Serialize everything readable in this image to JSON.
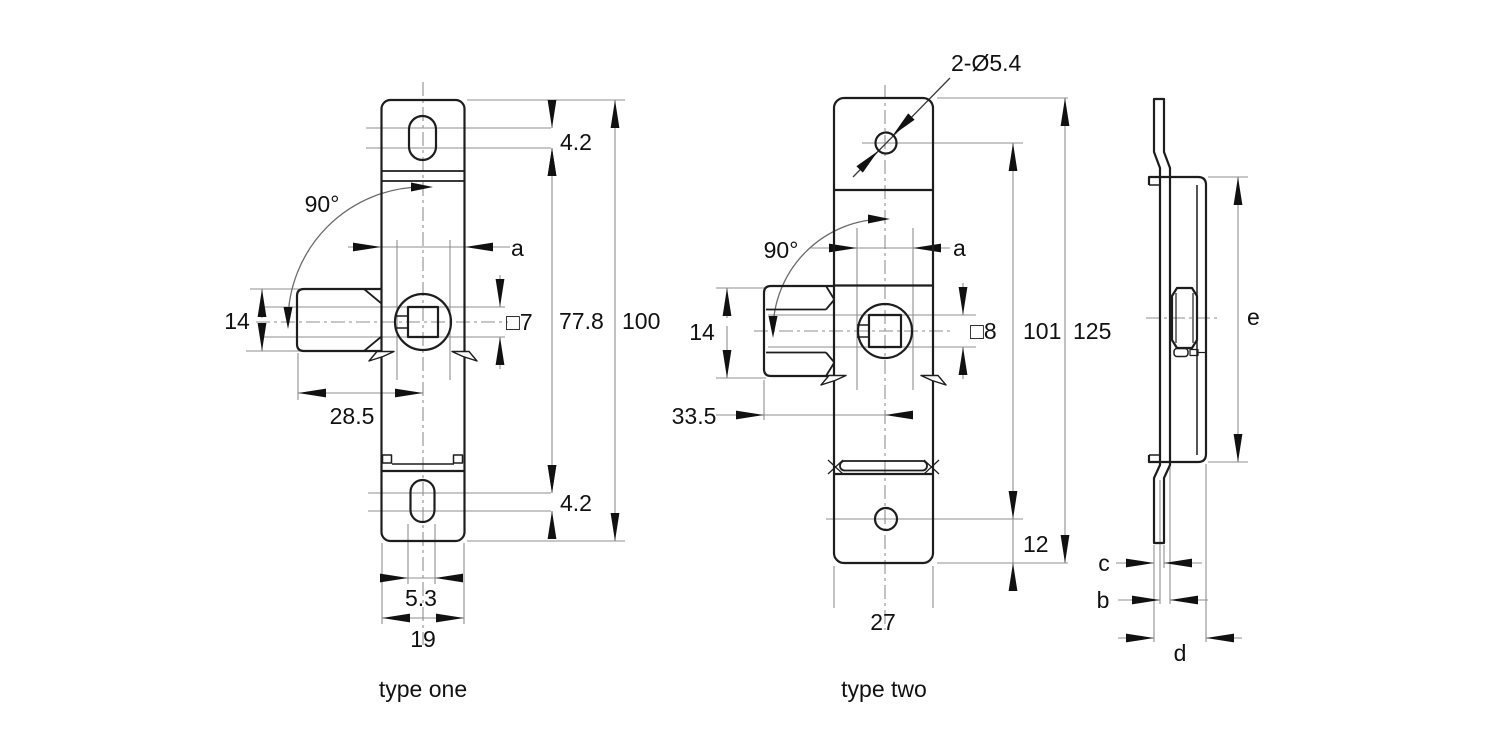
{
  "drawing": {
    "background_color": "#ffffff",
    "outline_color": "#1d1d1d",
    "thin_line_color": "#8f8f8f",
    "views": {
      "type_one": {
        "caption": "type one",
        "dims": {
          "top_slot_offset": "4.2",
          "angle": "90°",
          "width_a": "a",
          "bolt_height": "14",
          "square_hole": "□7",
          "slot_centers_spacing": "77.8",
          "total_height": "100",
          "bolt_length": "28.5",
          "bottom_slot_offset": "4.2",
          "slot_width": "5.3",
          "plate_width": "19"
        }
      },
      "type_two": {
        "caption": "type two",
        "dims": {
          "mount_holes": "2-Ø5.4",
          "angle": "90°",
          "width_a": "a",
          "bolt_height": "14",
          "square_hole": "□8",
          "hole_to_step": "101",
          "total_height": "125",
          "bolt_length": "33.5",
          "bottom_offset": "12",
          "plate_width": "27"
        }
      },
      "side_view": {
        "dims": {
          "height_e": "e",
          "thickness_c": "c",
          "thickness_b": "b",
          "depth_d": "d"
        }
      }
    }
  }
}
